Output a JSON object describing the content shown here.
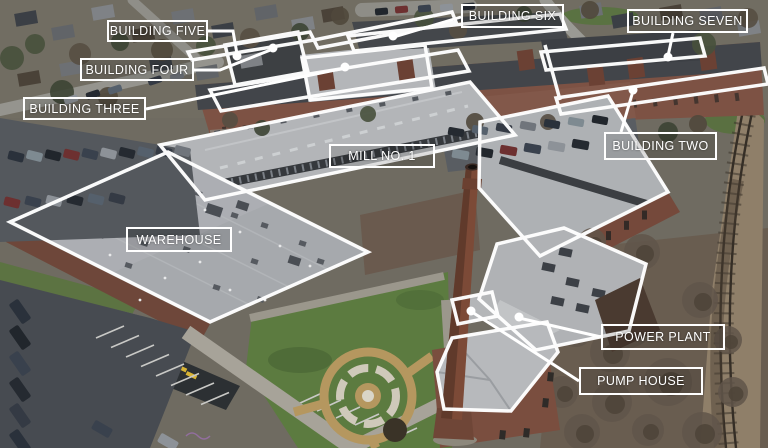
{
  "scene": {
    "type": "aerial-photo-annotated",
    "marker": "leader-dot-icon",
    "style": {
      "label_color": "#ffffff",
      "label_border": "#ffffff",
      "outline_color": "#ffffff"
    }
  },
  "annotations": {
    "labels": [
      {
        "id": "building-five",
        "text": "BUILDING FIVE"
      },
      {
        "id": "building-four",
        "text": "BUILDING FOUR"
      },
      {
        "id": "building-three",
        "text": "BUILDING THREE"
      },
      {
        "id": "building-six",
        "text": "BUILDING SIX"
      },
      {
        "id": "building-seven",
        "text": "BUILDING SEVEN"
      },
      {
        "id": "building-two",
        "text": "BUILDING TWO"
      },
      {
        "id": "mill-no-1",
        "text": "MILL NO. 1"
      },
      {
        "id": "warehouse",
        "text": "WAREHOUSE"
      },
      {
        "id": "power-plant",
        "text": "POWER PLANT"
      },
      {
        "id": "pump-house",
        "text": "PUMP HOUSE"
      }
    ]
  }
}
